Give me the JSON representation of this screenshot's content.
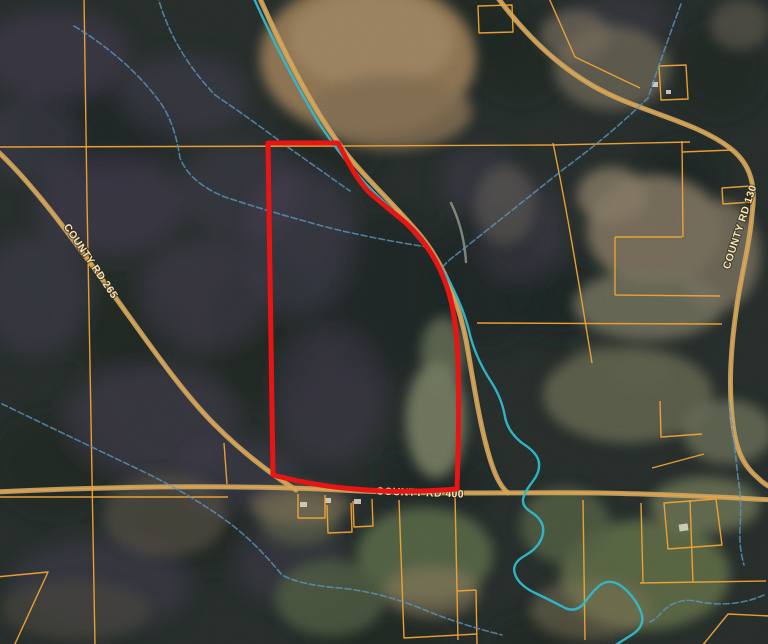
{
  "roads": {
    "left": "COUNTY RD 265",
    "right": "COUNTY RD 130",
    "bottom": "COUNTY RD 400"
  },
  "colors": {
    "boundary": "#e81515",
    "parcel-line": "#f0a335",
    "road-fill": "#c7a56a",
    "stream-bright": "#2fb9cd",
    "stream-faint": "#5b93bd",
    "label-text": "#f2e3bf",
    "forest-dark": "#1d2925",
    "forest-purple": "#5d4c6d",
    "field-tan": "#a3875f"
  }
}
